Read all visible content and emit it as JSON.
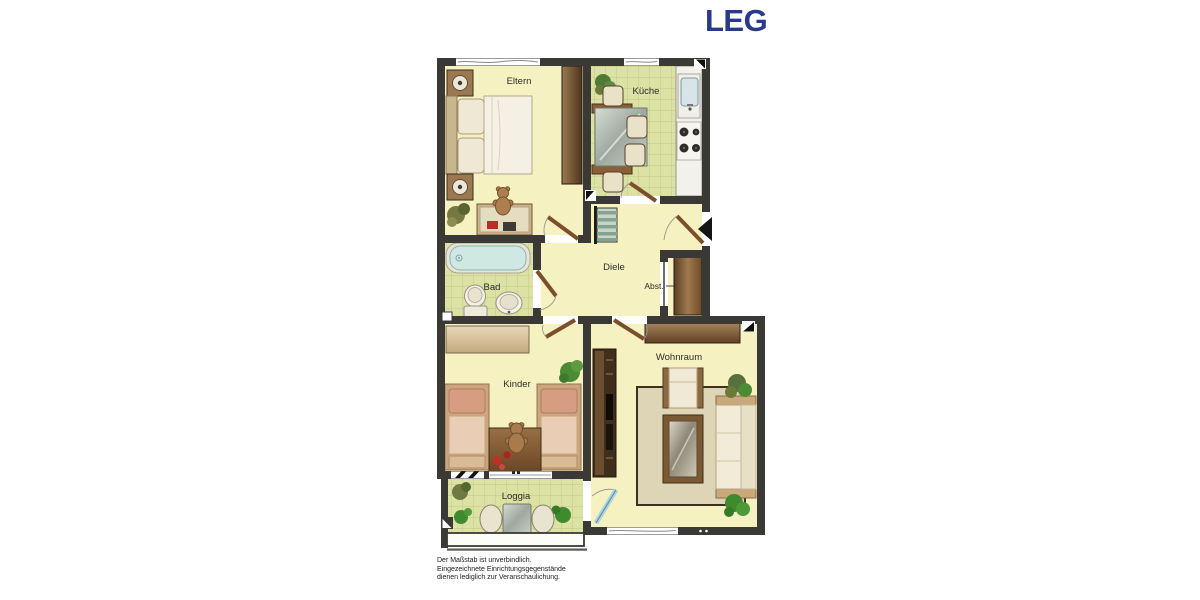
{
  "brand": {
    "logo_text": "LEG",
    "logo_color": "#29398b"
  },
  "floorplan": {
    "rooms": [
      {
        "id": "eltern",
        "label": "Eltern"
      },
      {
        "id": "kueche",
        "label": "Küche"
      },
      {
        "id": "diele",
        "label": "Diele"
      },
      {
        "id": "abst",
        "label": "Abst."
      },
      {
        "id": "bad",
        "label": "Bad"
      },
      {
        "id": "kinder",
        "label": "Kinder"
      },
      {
        "id": "wohnraum",
        "label": "Wohnraum"
      },
      {
        "id": "loggia",
        "label": "Loggia"
      }
    ]
  },
  "disclaimer": {
    "line1": "Der Maßstab ist unverbindlich.",
    "line2": "Eingezeichnete Einrichtungsgegenstände",
    "line3": "dienen lediglich zur Veranschaulichung."
  },
  "colors": {
    "wall": "#3b3936",
    "floor_yellow": "#f6f1c0",
    "tile_green": "#dce1a4",
    "door_brown": "#7a4f2a",
    "brand_blue": "#29398b"
  }
}
